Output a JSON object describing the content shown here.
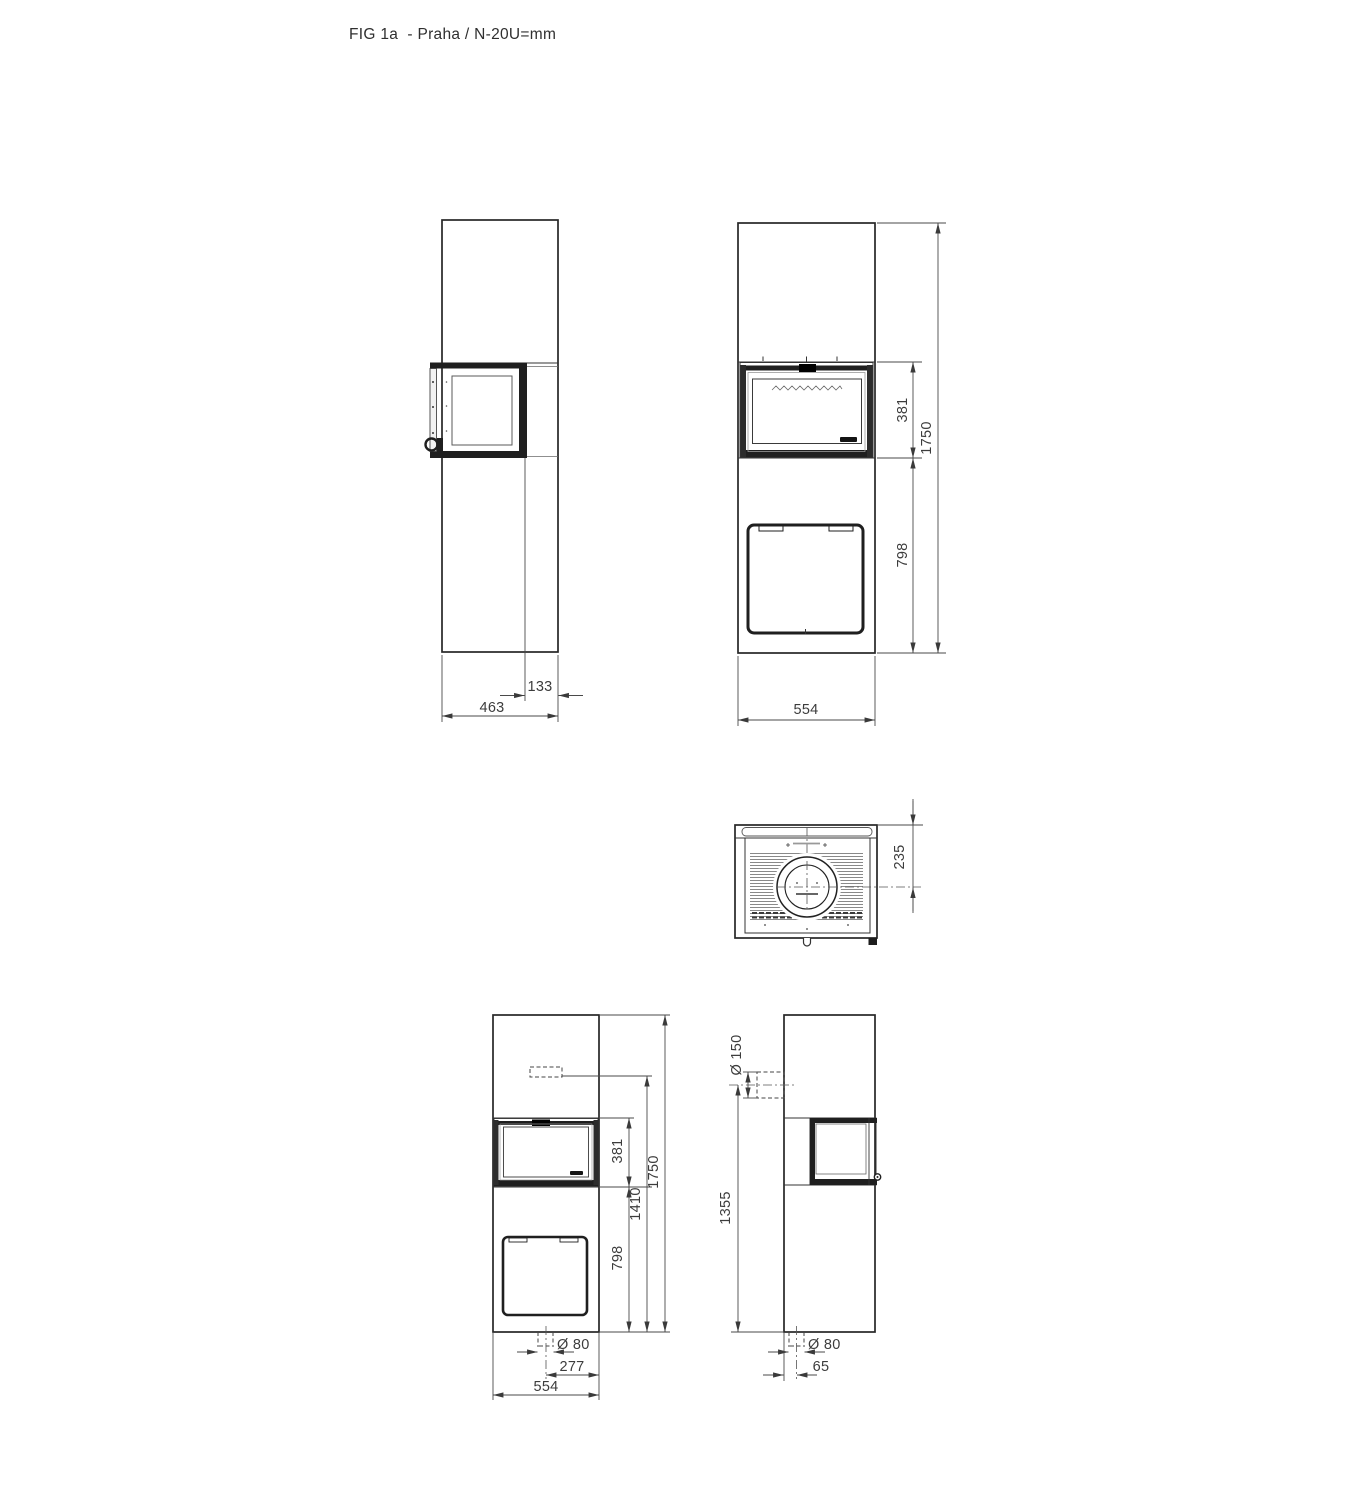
{
  "title": "FIG 1a  - Praha / N-20U=mm",
  "figure": {
    "id": "FIG 1a",
    "model": "Praha",
    "units_note": "N-20U=mm"
  },
  "colors": {
    "line": "#262626",
    "dimension": "#4a4a4a",
    "background": "#ffffff"
  },
  "views": {
    "side_left": {
      "dim_door_offset": "133",
      "dim_depth": "463"
    },
    "front": {
      "dim_window_height": "381",
      "dim_total_height": "1750",
      "dim_base_height": "798",
      "dim_width": "554"
    },
    "top": {
      "dim_flue_center": "235"
    },
    "front_lower": {
      "dim_window_height": "381",
      "dim_rear_outlet_height": "1410",
      "dim_total_height": "1750",
      "dim_base_height": "798",
      "dim_inlet_diameter": "Ø 80",
      "dim_inlet_offset": "277",
      "dim_width": "554"
    },
    "side_right": {
      "dim_rear_flue_diameter": "Ø 150",
      "dim_rear_flue_height": "1355",
      "dim_inlet_diameter": "Ø 80",
      "dim_inlet_offset": "65"
    }
  }
}
